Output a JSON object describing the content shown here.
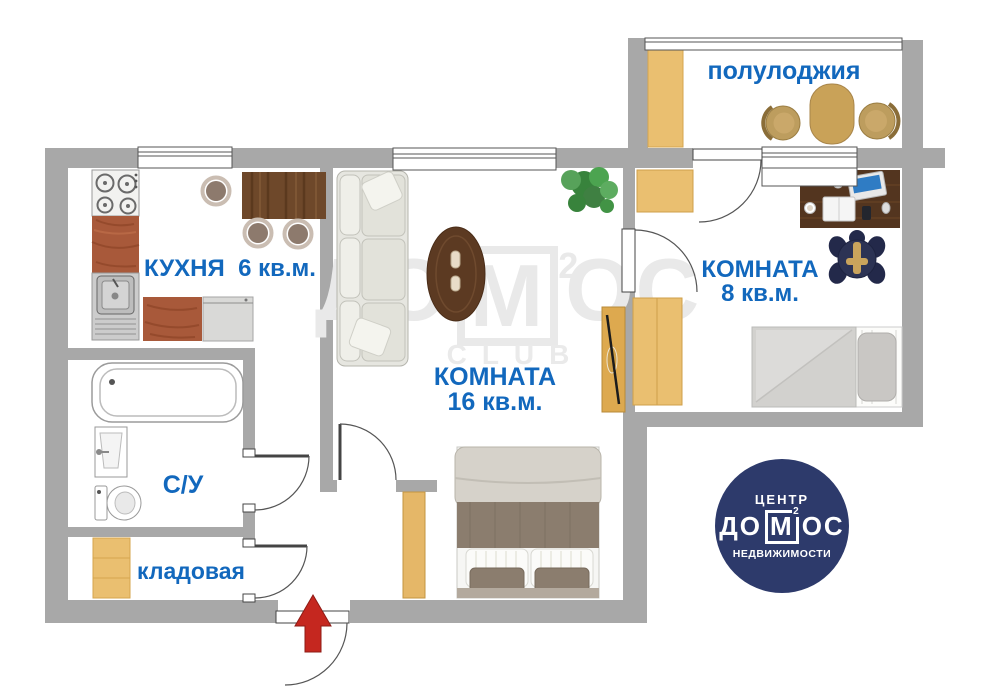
{
  "colors": {
    "wall": "#a8a8a8",
    "label_blue": "#1268bd",
    "logo_navy": "#2d3a6b",
    "arrow_red": "#c5271f",
    "wood_light": "#eabf70",
    "counter_brown": "#a8593a",
    "dark_wood": "#5a3a26",
    "watermark_gray": "#e9e9e9"
  },
  "rooms": {
    "balcony": {
      "label": "полулоджия"
    },
    "kitchen": {
      "label": "КУХНЯ  6 кв.м."
    },
    "room16": {
      "line1": "КОМНАТА",
      "line2": "16 кв.м."
    },
    "room8": {
      "line1": "КОМНАТА",
      "line2": "8 кв.м."
    },
    "bathroom": {
      "label": "С/У"
    },
    "storage": {
      "label": "кладовая"
    }
  },
  "watermark": {
    "before": "ДО",
    "boxed": "М",
    "sup": "2",
    "after": "ОС",
    "subtitle": "CLUB"
  },
  "logo": {
    "top": "ЦЕНТР",
    "before": "ДО",
    "boxed": "М",
    "sup": "2",
    "after": "ОС",
    "bottom": "НЕДВИЖИМОСТИ"
  }
}
